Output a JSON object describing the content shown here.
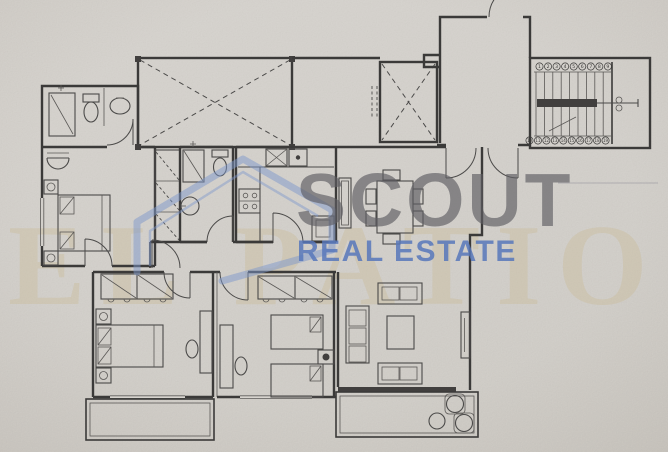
{
  "watermark": {
    "brand": "SCOUT",
    "tagline": "REAL ESTATE",
    "background_text": "EL PATIO",
    "brand_color": "#5f5e63",
    "tagline_color": "#5878bb",
    "house_outline_color": "#7d97cc",
    "background_text_color": "#c9b88f"
  },
  "floor_plan": {
    "paper_color": "#d7d4cf",
    "line_color": "#3b3a39",
    "stair_numbers_up": [
      "1",
      "2",
      "3",
      "4",
      "5",
      "6",
      "7",
      "8",
      "9"
    ],
    "stair_numbers_down": [
      "10",
      "11",
      "12",
      "13",
      "14",
      "15",
      "16",
      "17",
      "18",
      "19"
    ]
  }
}
